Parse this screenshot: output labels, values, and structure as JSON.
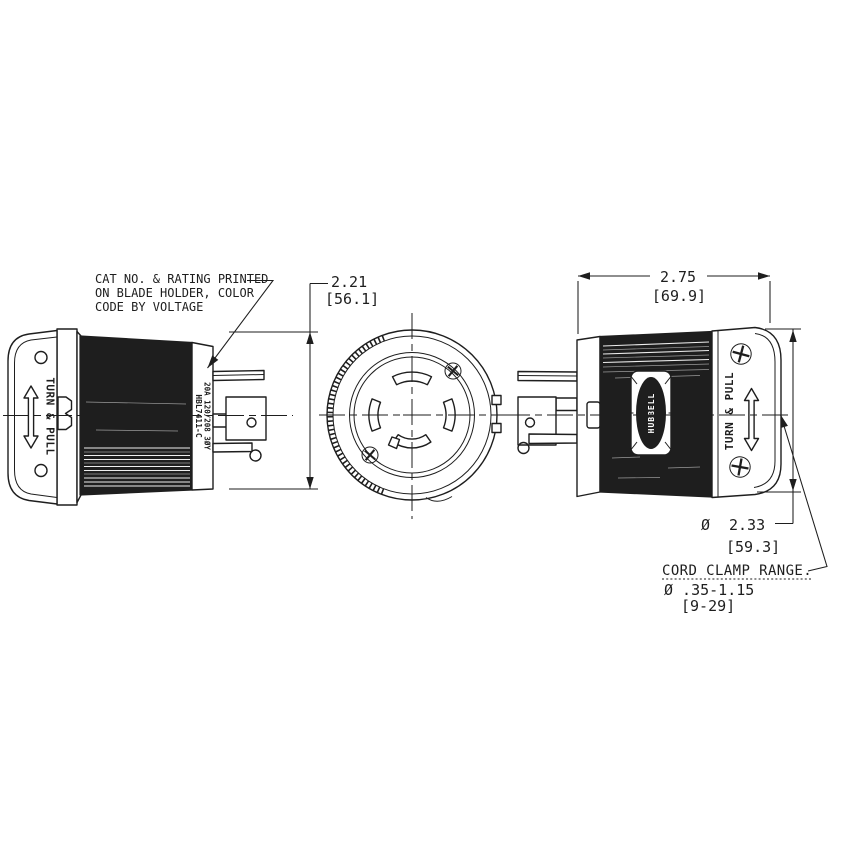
{
  "note": {
    "line1": "CAT NO. & RATING PRINTED",
    "line2": "ON BLADE HOLDER, COLOR",
    "line3": "CODE BY VOLTAGE"
  },
  "dimensions": {
    "body_diameter_in": "2.21",
    "body_diameter_mm": "[56.1]",
    "length_in": "2.75",
    "length_mm": "[69.9]",
    "back_diameter_symbol": "Ø",
    "back_diameter_in": "2.33",
    "back_diameter_mm": "[59.3]",
    "cord_clamp_label": "CORD CLAMP RANGE.",
    "cord_clamp_range_in": "Ø .35-1.15",
    "cord_clamp_range_mm": "[9-29]"
  },
  "views": {
    "left": {
      "turn_pull": "TURN & PULL",
      "cat_no": "HBL7411-C",
      "rating": "20A 120/208 3ØY"
    },
    "right": {
      "turn_pull": "TURN & PULL",
      "brand": "HUBBELL"
    }
  },
  "colors": {
    "line": "#1e1e1e",
    "background": "#ffffff"
  }
}
